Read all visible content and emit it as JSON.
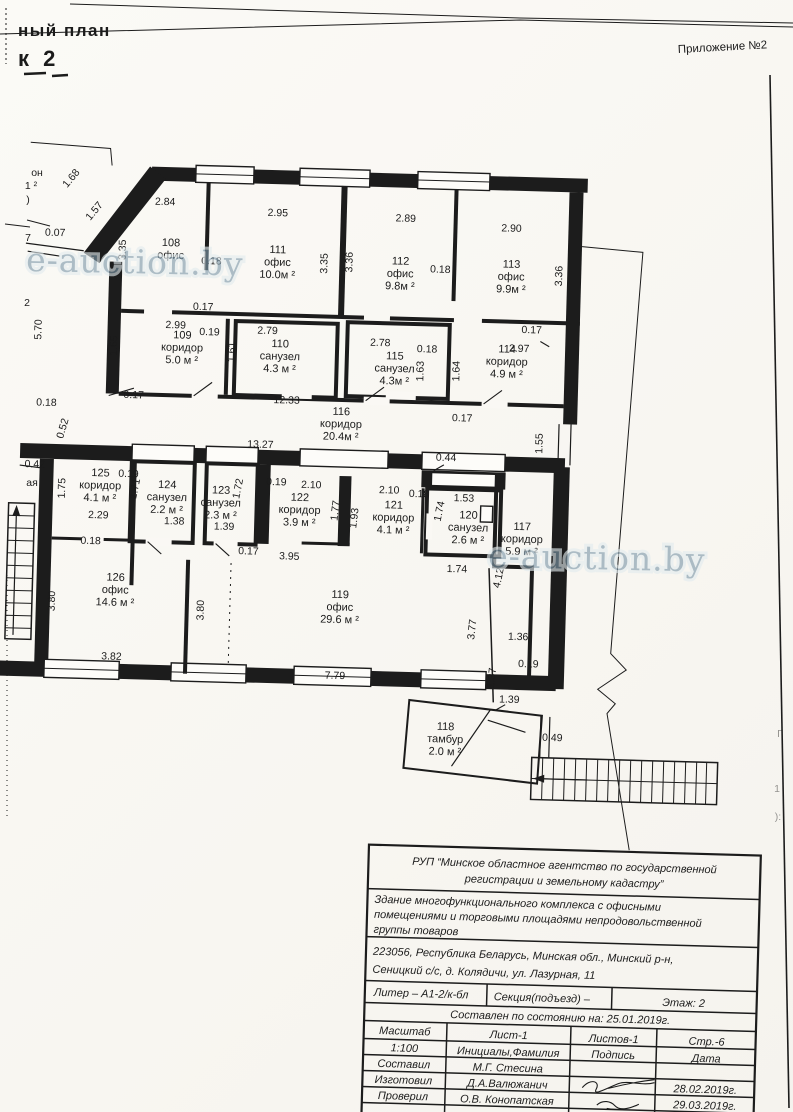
{
  "page": {
    "bg": "#faf8f4",
    "ink": "#1c1c1c"
  },
  "header": {
    "plan_title_fragment": "ный план",
    "plan_number_fragment": "к  2",
    "annex_label": "Приложение №2"
  },
  "watermarks": [
    {
      "text": "e-auction.by"
    },
    {
      "text": "e-auction.by"
    }
  ],
  "plan": {
    "rooms": [
      {
        "number": "108",
        "name": "офис",
        "area": "",
        "x": 173,
        "y": 245
      },
      {
        "number": "111",
        "name": "офис",
        "area": "10.0м ²",
        "x": 280,
        "y": 249
      },
      {
        "number": "112",
        "name": "офис",
        "area": "9.8м ²",
        "x": 403,
        "y": 257
      },
      {
        "number": "113",
        "name": "офис",
        "area": "9.9м ²",
        "x": 514,
        "y": 257
      },
      {
        "number": "109",
        "name": "коридор",
        "area": "5.0 м ²",
        "x": 187,
        "y": 337
      },
      {
        "number": "110",
        "name": "санузел",
        "area": "4.3 м ²",
        "x": 285,
        "y": 343
      },
      {
        "number": "115",
        "name": "санузел",
        "area": "4.3м ²",
        "x": 400,
        "y": 352
      },
      {
        "number": "114",
        "name": "коридор",
        "area": "4.9 м ²",
        "x": 512,
        "y": 342
      },
      {
        "number": "116",
        "name": "коридор",
        "area": "20.4м ²",
        "x": 348,
        "y": 409
      },
      {
        "number": "125",
        "name": "коридор",
        "area": "4.1 м ²",
        "x": 109,
        "y": 477
      },
      {
        "number": "124",
        "name": "санузел",
        "area": "2.2 м ²",
        "x": 176,
        "y": 487
      },
      {
        "number": "123",
        "name": "санузел",
        "area": "2.3 м ²",
        "x": 230,
        "y": 491
      },
      {
        "number": "122",
        "name": "коридор",
        "area": "3.9 м ²",
        "x": 309,
        "y": 496
      },
      {
        "number": "121",
        "name": "коридор",
        "area": "4.1 м ²",
        "x": 403,
        "y": 501
      },
      {
        "number": "120",
        "name": "санузел",
        "area": "2.6 м ²",
        "x": 478,
        "y": 509
      },
      {
        "number": "117",
        "name": "коридор",
        "area": "5.9 м ²",
        "x": 532,
        "y": 519
      },
      {
        "number": "126",
        "name": "офис",
        "area": "14.6 м ²",
        "x": 127,
        "y": 581
      },
      {
        "number": "119",
        "name": "офис",
        "area": "29.6 м ²",
        "x": 352,
        "y": 592
      },
      {
        "number": "118",
        "name": "тамбур",
        "area": "2.0 м ²",
        "x": 461,
        "y": 721
      }
    ],
    "dimensions": [
      {
        "t": "1.68",
        "x": 74,
        "y": 182,
        "r": -52
      },
      {
        "t": "1.57",
        "x": 98,
        "y": 214,
        "r": -52
      },
      {
        "t": "0.07",
        "x": 57,
        "y": 238
      },
      {
        "t": "5.70",
        "x": 46,
        "y": 332,
        "r": -90
      },
      {
        "t": "3.35",
        "x": 128,
        "y": 250,
        "r": -90
      },
      {
        "t": "2.84",
        "x": 166,
        "y": 204
      },
      {
        "t": "2.95",
        "x": 279,
        "y": 212
      },
      {
        "t": "2.89",
        "x": 407,
        "y": 214
      },
      {
        "t": "2.90",
        "x": 513,
        "y": 221
      },
      {
        "t": "0.18",
        "x": 214,
        "y": 262
      },
      {
        "t": "0.18",
        "x": 443,
        "y": 264
      },
      {
        "t": "3.35",
        "x": 330,
        "y": 258,
        "r": -90
      },
      {
        "t": "3.36",
        "x": 355,
        "y": 256,
        "r": -90
      },
      {
        "t": "3.36",
        "x": 565,
        "y": 264,
        "r": -90
      },
      {
        "t": "0.17",
        "x": 207,
        "y": 308
      },
      {
        "t": "2.99",
        "x": 180,
        "y": 327
      },
      {
        "t": "1.65",
        "x": 122,
        "y": 346,
        "r": -90
      },
      {
        "t": "0.19",
        "x": 214,
        "y": 333
      },
      {
        "t": "2.79",
        "x": 272,
        "y": 330
      },
      {
        "t": "1.61",
        "x": 240,
        "y": 349,
        "r": -90
      },
      {
        "t": "2.78",
        "x": 385,
        "y": 339
      },
      {
        "t": "0.18",
        "x": 432,
        "y": 344
      },
      {
        "t": "1.63",
        "x": 429,
        "y": 363,
        "r": -90
      },
      {
        "t": "1.64",
        "x": 465,
        "y": 362,
        "r": -90
      },
      {
        "t": "0.17",
        "x": 536,
        "y": 322
      },
      {
        "t": "2.97",
        "x": 524,
        "y": 341
      },
      {
        "t": "0.17",
        "x": 140,
        "y": 398
      },
      {
        "t": "12.33",
        "x": 293,
        "y": 399
      },
      {
        "t": "0.17",
        "x": 469,
        "y": 412
      },
      {
        "t": "1.55",
        "x": 550,
        "y": 432,
        "r": -90
      },
      {
        "t": "13.27",
        "x": 268,
        "y": 444
      },
      {
        "t": "0.44",
        "x": 454,
        "y": 452
      },
      {
        "t": "0.18",
        "x": 53,
        "y": 408
      },
      {
        "t": "0.52",
        "x": 73,
        "y": 431,
        "r": -75
      },
      {
        "t": "0.42",
        "x": 43,
        "y": 470
      },
      {
        "t": "1.75",
        "x": 74,
        "y": 490,
        "r": -90
      },
      {
        "t": "0.19",
        "x": 137,
        "y": 477
      },
      {
        "t": "1.71",
        "x": 147,
        "y": 489,
        "r": -80
      },
      {
        "t": "1.72",
        "x": 250,
        "y": 486,
        "r": -80
      },
      {
        "t": "0.19",
        "x": 285,
        "y": 481
      },
      {
        "t": "2.10",
        "x": 320,
        "y": 483
      },
      {
        "t": "2.10",
        "x": 398,
        "y": 486
      },
      {
        "t": "0.18",
        "x": 428,
        "y": 489
      },
      {
        "t": "1.53",
        "x": 473,
        "y": 492
      },
      {
        "t": "1.74",
        "x": 452,
        "y": 503,
        "r": -80
      },
      {
        "t": "1.77",
        "x": 348,
        "y": 505,
        "r": -85
      },
      {
        "t": "1.93",
        "x": 367,
        "y": 512,
        "r": -85
      },
      {
        "t": "2.29",
        "x": 108,
        "y": 519
      },
      {
        "t": "0.18",
        "x": 101,
        "y": 545
      },
      {
        "t": "1.38",
        "x": 184,
        "y": 523
      },
      {
        "t": "1.39",
        "x": 234,
        "y": 527
      },
      {
        "t": "0.17",
        "x": 259,
        "y": 551
      },
      {
        "t": "3.95",
        "x": 300,
        "y": 555
      },
      {
        "t": "1.74",
        "x": 468,
        "y": 563
      },
      {
        "t": "4.12",
        "x": 513,
        "y": 568,
        "r": -80
      },
      {
        "t": "3.80",
        "x": 67,
        "y": 603,
        "r": -90
      },
      {
        "t": "3.80",
        "x": 216,
        "y": 608,
        "r": -90
      },
      {
        "t": "3.82",
        "x": 125,
        "y": 660
      },
      {
        "t": "7.79",
        "x": 349,
        "y": 673
      },
      {
        "t": "3.77",
        "x": 488,
        "y": 620,
        "r": -85
      },
      {
        "t": "1.36",
        "x": 531,
        "y": 629
      },
      {
        "t": "0.19",
        "x": 542,
        "y": 656
      },
      {
        "t": "1.37",
        "x": 509,
        "y": 668,
        "r": -85
      },
      {
        "t": "1.39",
        "x": 524,
        "y": 692
      },
      {
        "t": "0.49",
        "x": 568,
        "y": 729
      }
    ],
    "fragments": [
      {
        "t": "он",
        "x": 37,
        "y": 176
      },
      {
        "t": "1 ²",
        "x": 31,
        "y": 189
      },
      {
        "t": ")",
        "x": 28,
        "y": 203
      },
      {
        "t": "7",
        "x": 28,
        "y": 241
      },
      {
        "t": "2",
        "x": 27,
        "y": 306
      },
      {
        "t": "ая",
        "x": 32,
        "y": 486
      },
      {
        "t": "Г",
        "x": 780,
        "y": 737,
        "f": true
      },
      {
        "t": "1",
        "x": 777,
        "y": 792,
        "f": true
      },
      {
        "t": "):",
        "x": 778,
        "y": 820,
        "f": true
      }
    ]
  },
  "title_block": {
    "agency": [
      "РУП “Минское областное агентство по государственной",
      "регистрации и земельному кадастру”"
    ],
    "building": [
      "Здание многофункционального комплекса с офисными",
      "помещениями и торговыми площадями непродовольственной",
      "группы товаров"
    ],
    "address": [
      "223056, Республика Беларусь, Минская обл., Минский р-н,",
      "Сеницкий с/с, д. Колядичи, ул. Лазурная, 11"
    ],
    "liter": "Литер – А1-2/к-бл",
    "section": "Секция(подъезд) –",
    "floor": "Этаж: 2",
    "as_of": "Составлен по состоянию на: 25.01.2019г.",
    "scale_label": "Масштаб",
    "scale_value": "1:100",
    "sheet": "Лист-1",
    "sheets": "Листов-1",
    "page_no": "Стр.-6",
    "col_initials": "Инициалы,Фамилия",
    "col_signature": "Подпись",
    "col_date": "Дата",
    "rows": [
      {
        "role": "Составил",
        "name": "М.Г. Стесина",
        "date": ""
      },
      {
        "role": "Изготовил",
        "name": "Д.А.Валюжанич",
        "date": "28.02.2019г."
      },
      {
        "role": "Проверил",
        "name": "О.В. Конопатская",
        "date": "29.03.2019г."
      }
    ]
  }
}
